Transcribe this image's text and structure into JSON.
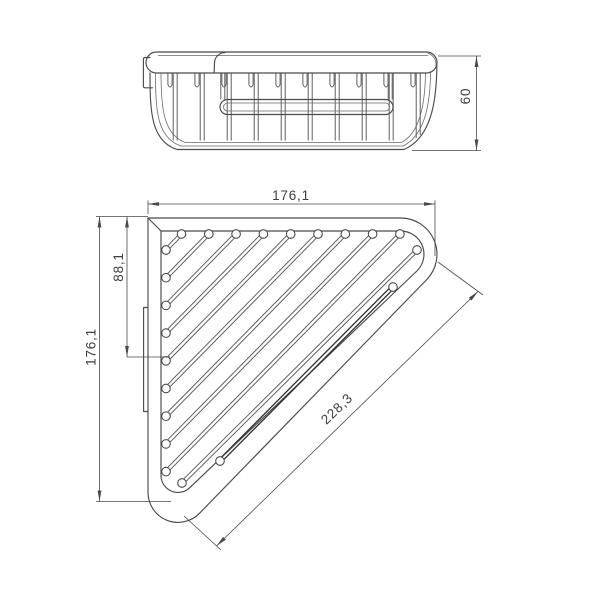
{
  "drawing": {
    "type": "technical-dimension-drawing",
    "subject": "corner wire basket shelf, side elevation and plan view",
    "background_color": "#ffffff",
    "line_color": "#4b4b4b",
    "dim_line_color": "#4a4a4a",
    "dim_text_color": "#3e3e3e",
    "dimensions": {
      "side_height": "60",
      "plan_top_width": "176,1",
      "plan_left_height": "176,1",
      "plan_inner_height": "88,1",
      "plan_diagonal": "228,3"
    }
  }
}
